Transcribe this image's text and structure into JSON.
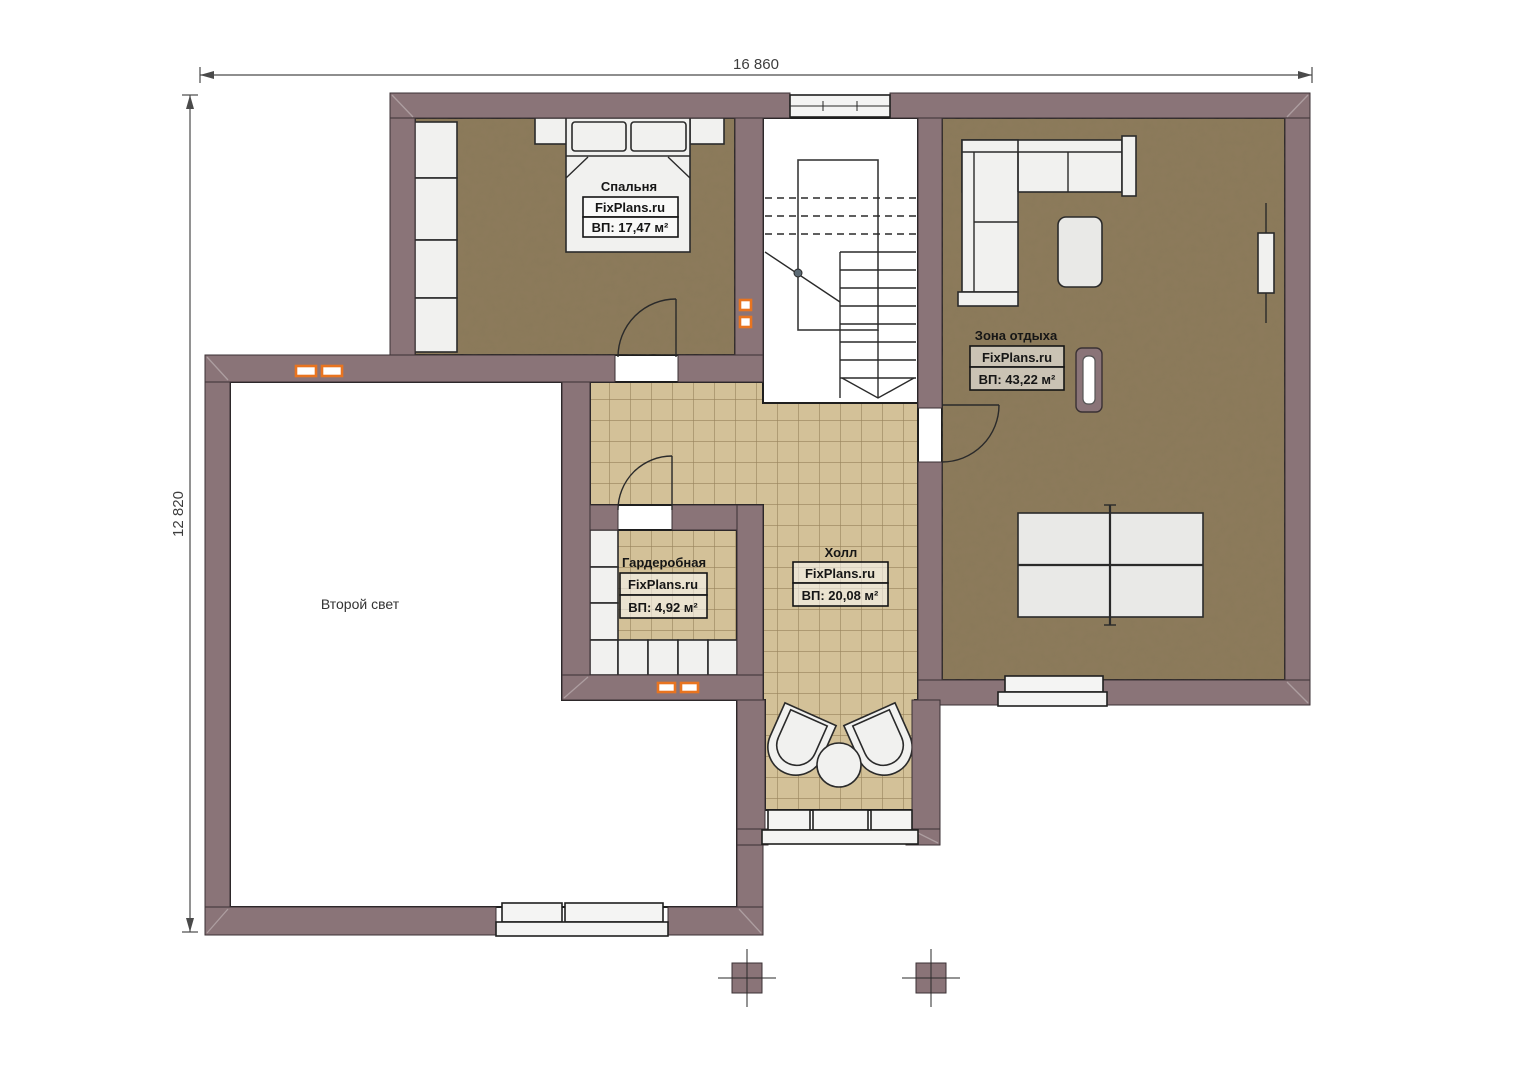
{
  "plan": {
    "kind": "second-floor-plan",
    "dimensions": {
      "width_label": "16 860",
      "height_label": "12 820"
    },
    "rooms": {
      "bedroom": {
        "name": "Спальня",
        "brand": "FixPlans.ru",
        "area": "ВП: 17,47 м²"
      },
      "lounge": {
        "name": "Зона отдыха",
        "brand": "FixPlans.ru",
        "area": "ВП: 43,22 м²"
      },
      "wardrobe": {
        "name": "Гардеробная",
        "brand": "FixPlans.ru",
        "area": "ВП: 4,92 м²"
      },
      "hall": {
        "name": "Холл",
        "brand": "FixPlans.ru",
        "area": "ВП: 20,08 м²"
      },
      "void": {
        "name": "Второй свет"
      }
    },
    "colors": {
      "wall": "#8a7478",
      "wood_floor": "#8d7b5c",
      "tile_floor": "#d3c198",
      "tile_grid": "#97835c",
      "radiator_accent": "#e87420",
      "line": "#2a2a2a",
      "label_text": "#161616"
    }
  }
}
